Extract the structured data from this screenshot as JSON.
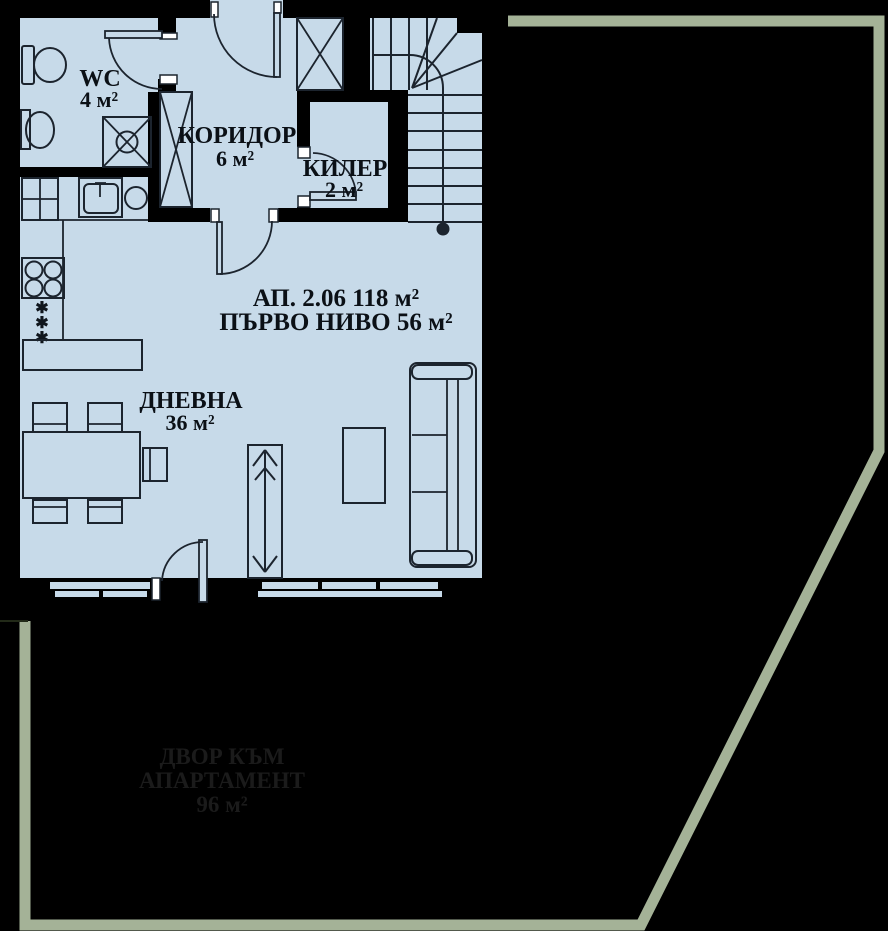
{
  "rooms": {
    "wc": {
      "name": "WC",
      "area": "4 м²"
    },
    "corridor": {
      "name": "КОРИДОР",
      "area": "6 м²"
    },
    "storage": {
      "name": "КИЛЕР",
      "area": "2 м²"
    },
    "living": {
      "name": "ДНЕВНА",
      "area": "36 м²"
    }
  },
  "apartment": {
    "id_line": "АП. 2.06 118 м²",
    "level_line": "ПЪРВО НИВО 56 м²"
  },
  "yard": {
    "line1": "ДВОР КЪМ",
    "line2": "АПАРТАМЕНТ",
    "line3": "96 м²"
  },
  "symbols": {
    "hot_water_star": "✱"
  },
  "colors": {
    "background": "#000000",
    "wall": "#000000",
    "room_fill": "#c7dae9",
    "drawing_line": "#1c242e",
    "yard_outline": "#a4b297",
    "yard_text": "#1b1b1b",
    "jamb_fill": "#ffffff"
  }
}
